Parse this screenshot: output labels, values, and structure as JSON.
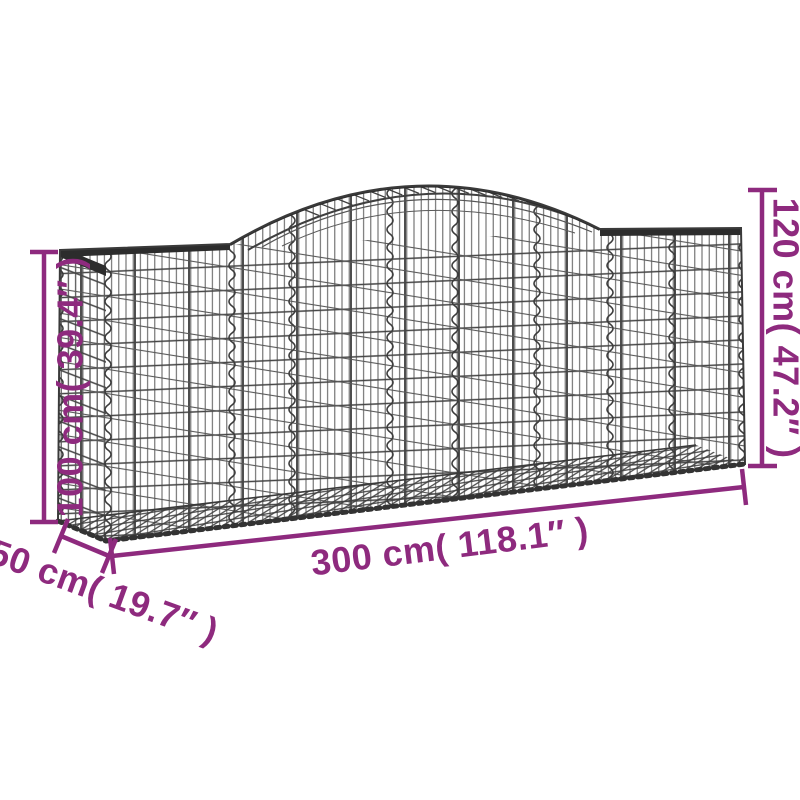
{
  "diagram": {
    "subject": "arched-gabion-basket",
    "dimensions": {
      "height_left": "100 cm( 39.4″ )",
      "height_right": "120 cm( 47.2″ )",
      "length": "300 cm( 118.1″ )",
      "depth": "50 cm( 19.7″ )"
    },
    "colors": {
      "accent": "#8e2a7e",
      "wire": "#3a3a3a",
      "wire_dark": "#2c2c2c",
      "background": "#ffffff"
    }
  }
}
